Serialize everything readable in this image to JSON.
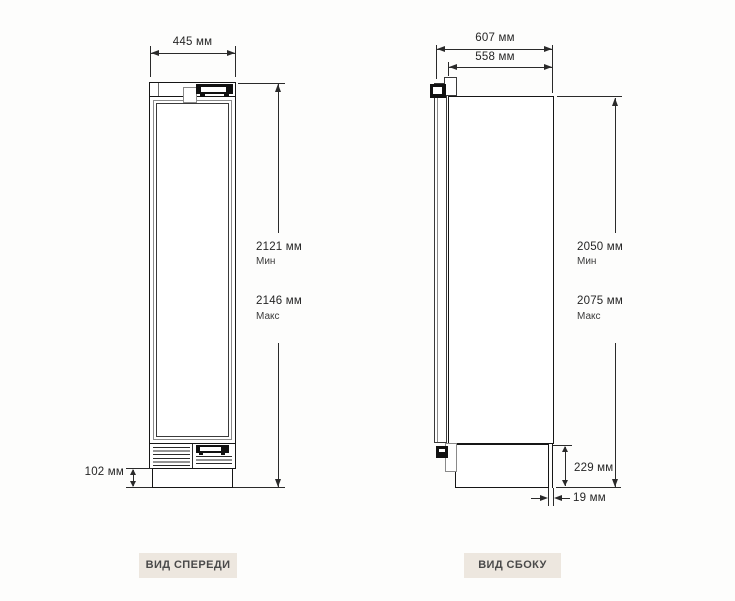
{
  "front_view": {
    "caption": "ВИД СПЕРЕДИ",
    "width_dim": "445 мм",
    "height_min_value": "2121 мм",
    "height_min_qualifier": "Мин",
    "height_max_value": "2146 мм",
    "height_max_qualifier": "Макс",
    "plinth_height": "102 мм"
  },
  "side_view": {
    "caption": "ВИД СБОКУ",
    "depth_with_door": "607 мм",
    "depth_without_door": "558 мм",
    "height_min_value": "2050 мм",
    "height_min_qualifier": "Мин",
    "height_max_value": "2075 мм",
    "height_max_qualifier": "Макс",
    "base_height": "229 мм",
    "rear_gap": "19 мм"
  },
  "colors": {
    "background": "#fdfdfc",
    "caption_background": "#ede7df",
    "caption_text": "#4a4a4a",
    "line": "#2a2a2a"
  },
  "units": "мм"
}
